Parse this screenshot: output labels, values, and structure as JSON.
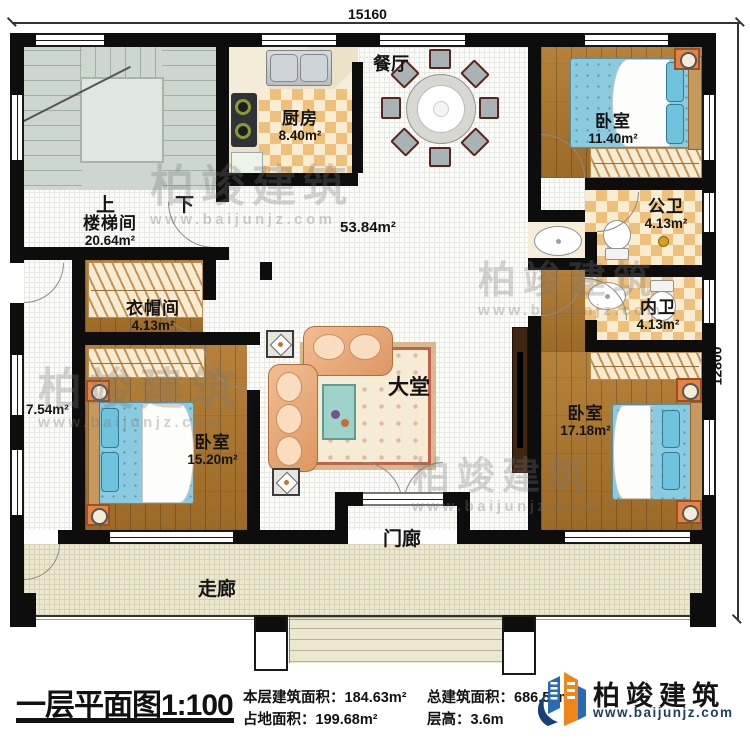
{
  "dimensions": {
    "top": "15160",
    "right": "12800"
  },
  "rooms": {
    "stairwell": {
      "label": "楼梯间",
      "area": "20.64m²"
    },
    "stair_up": "上",
    "stair_down": "下",
    "kitchen": {
      "label": "厨房",
      "area": "8.40m²"
    },
    "dining": {
      "label": "餐厅"
    },
    "hall": {
      "label": "大堂",
      "area": "53.84m²"
    },
    "bedroom_top_right": {
      "label": "卧室",
      "area": "11.40m²"
    },
    "public_bath": {
      "label": "公卫",
      "area": "4.13m²"
    },
    "inner_bath": {
      "label": "内卫",
      "area": "4.13m²"
    },
    "cloakroom": {
      "label": "衣帽间",
      "area": "4.13m²"
    },
    "bedroom_bottom_left": {
      "label": "卧室",
      "area": "15.20m²"
    },
    "bedroom_right": {
      "label": "卧室",
      "area": "17.18m²"
    },
    "side_hall": {
      "area": "7.54m²"
    },
    "veranda": {
      "label": "走廊"
    },
    "porch": {
      "label": "门廊"
    }
  },
  "footer": {
    "title": "一层平面图1:100",
    "stats": [
      "本层建筑面积：184.63m²",
      "占地面积：199.68m²",
      "总建筑面积：686.50m²",
      "层高：3.6m"
    ],
    "brand": {
      "name": "柏竣建筑",
      "website": "www.baijunjz.com"
    }
  },
  "watermark": {
    "name": "柏竣建筑",
    "website": "www.baijunjz.com"
  },
  "colors": {
    "wall": "#0d0d0d",
    "brand_blue": "#2a6ab5",
    "brand_orange": "#f08519",
    "brand_navy": "#1b3e63"
  }
}
